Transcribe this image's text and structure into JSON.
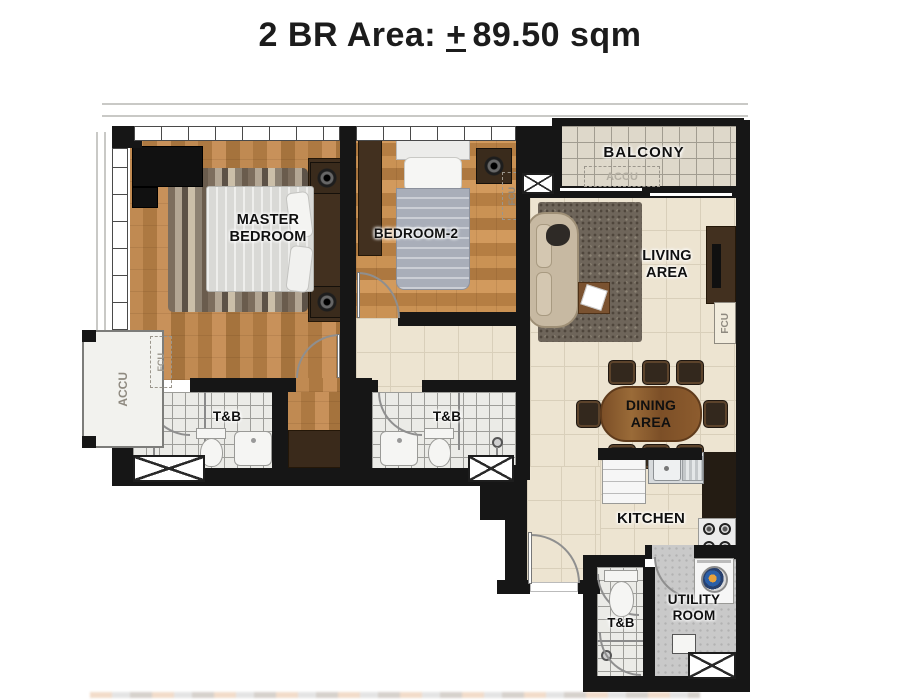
{
  "title": {
    "before": "2 BR Area:",
    "pm": "+",
    "after": "89.50 sqm"
  },
  "rooms": {
    "master": {
      "l1": "MASTER",
      "l2": "BEDROOM"
    },
    "bedroom2": {
      "label": "BEDROOM-2"
    },
    "balcony": {
      "label": "BALCONY"
    },
    "living": {
      "l1": "LIVING",
      "l2": "AREA"
    },
    "dining": {
      "l1": "DINING",
      "l2": "AREA"
    },
    "kitchen": {
      "label": "KITCHEN"
    },
    "tnb_master": {
      "label": "T&B"
    },
    "tnb_common": {
      "label": "T&B"
    },
    "tnb_service": {
      "label": "T&B"
    },
    "utility": {
      "l1": "UTILITY",
      "l2": "ROOM"
    }
  },
  "equipment": {
    "accu_ledge": "ACCU",
    "fcu_master": "FCU",
    "fcu_bedroom2": "FCU",
    "accu_balcony": "ACCU",
    "fcu_living": "FCU"
  },
  "colors": {
    "wall": "#161616",
    "wood_floor": "#b9834c",
    "tile_floor": "#ede4d1",
    "bath_tile": "#ebebe7",
    "balcony_tile": "#ded8ca",
    "concrete": "#c9c9c9",
    "dark_wood": "#42301f"
  }
}
